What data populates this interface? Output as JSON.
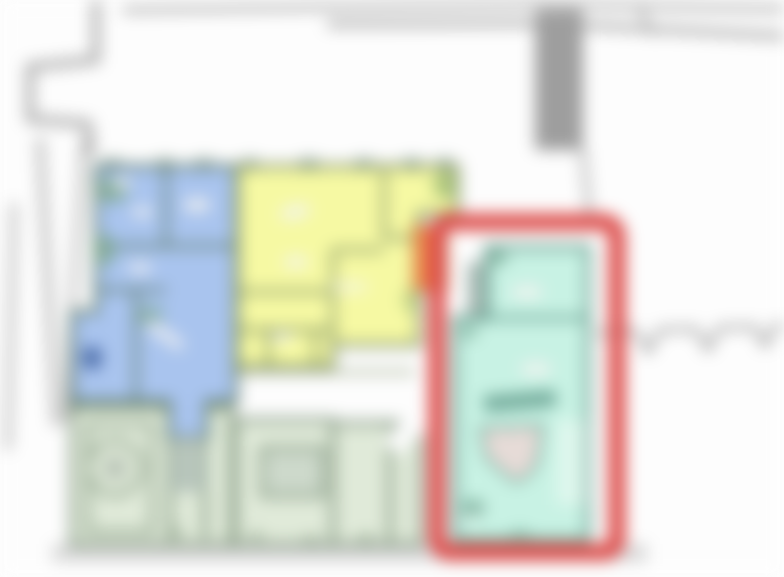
{
  "map": {
    "type": "cadastral-floor-plan-blurred",
    "background": "#fdfdfd",
    "road_color": "#a8a8a8",
    "structure_bar_color": "#9e9e9e",
    "ground_band_color": "#d9d9d9",
    "boundary_tooth_color": "#9a9a9a",
    "label_blob_color": "#f3f3f1",
    "units": {
      "blue": {
        "fill": "#a9c4ee",
        "wall": "#5e7b6c",
        "accent": "#3d5f9e",
        "tree": "#7fa98c"
      },
      "yellow": {
        "fill": "#f6f9a3",
        "wall": "#7d8f63",
        "tree": "#9ab873"
      },
      "orange": {
        "fill": "#ec8a4a",
        "wall": "#b86a33"
      },
      "cyan": {
        "fill": "#c8f2e4",
        "wall": "#569181",
        "tree": "#6fa18d",
        "symbol_fill": "#ead9d6"
      },
      "green": {
        "fill": "#e0ead9",
        "wall": "#7f947d",
        "inner": "#cdd9cb",
        "circle_core": "#b9c4b7"
      }
    },
    "highlight": {
      "color": "#dc4b49"
    }
  }
}
